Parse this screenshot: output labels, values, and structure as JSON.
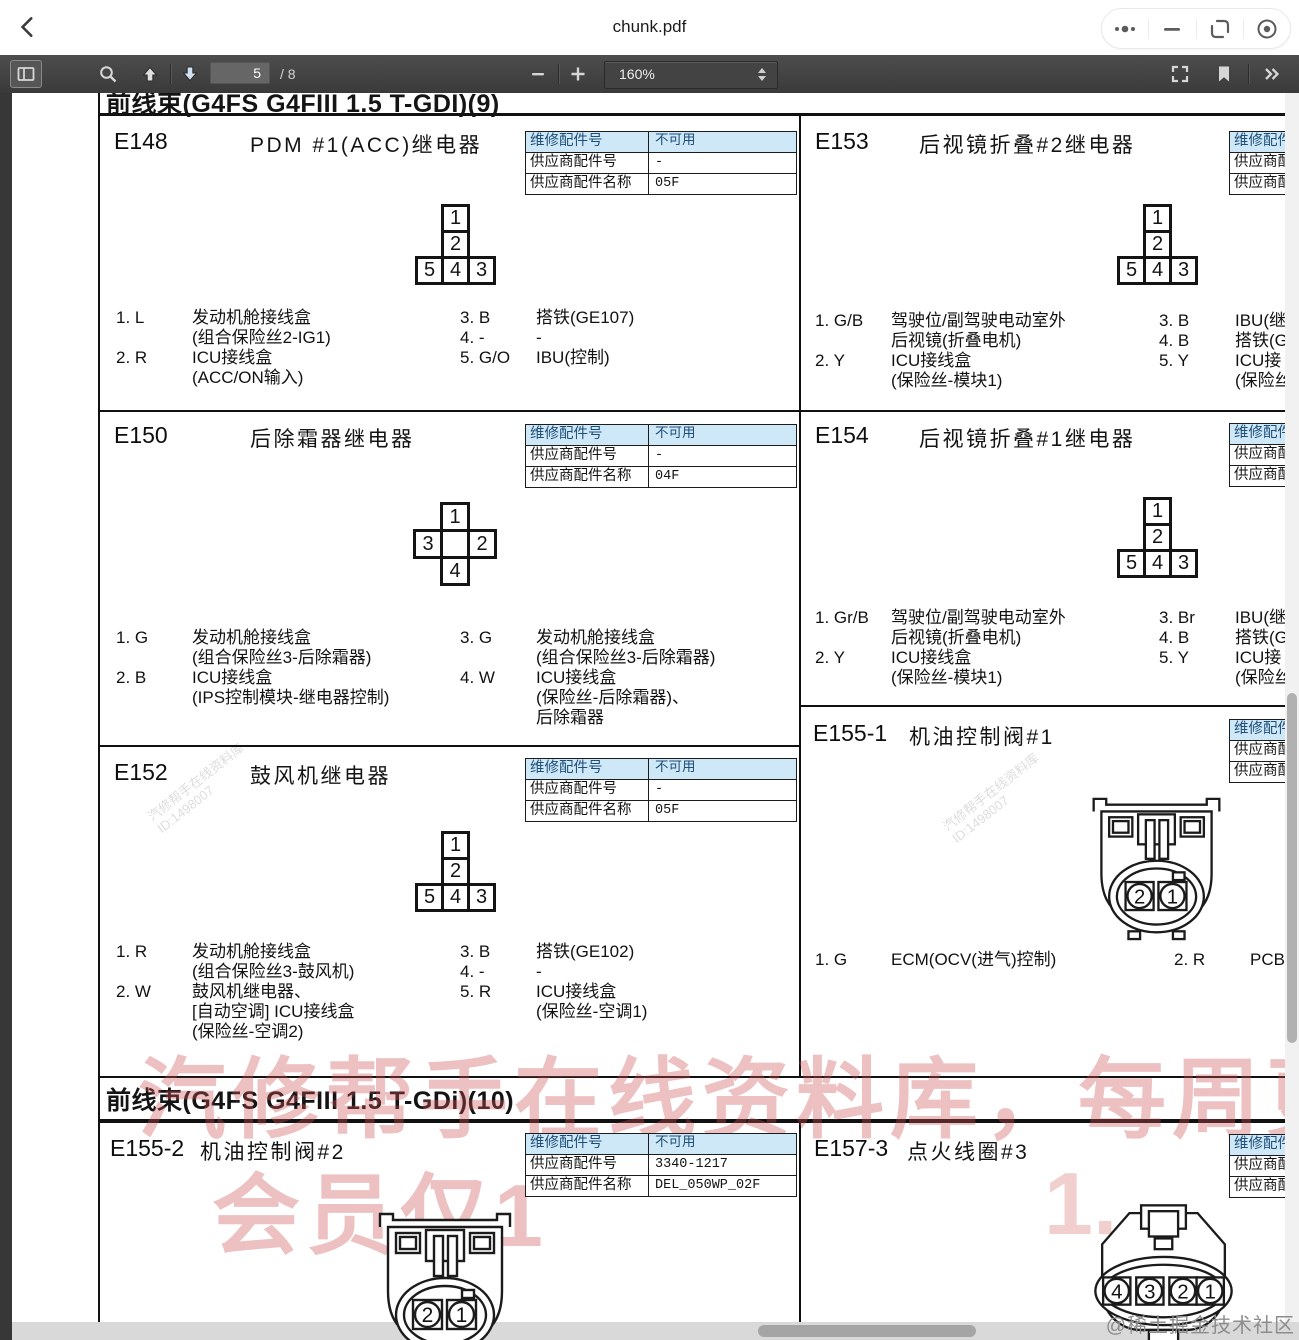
{
  "window": {
    "title": "chunk.pdf"
  },
  "toolbar": {
    "page": "5",
    "page_total": "/ 8",
    "zoom": "160%"
  },
  "headers": {
    "section9": "前线束(G4FS  G4FIII 1.5 T-GDI)(9)",
    "section10": "前线束(G4FS  G4FIII 1.5 T-GDi)(10)"
  },
  "table_labels": [
    "维修配件号",
    "供应商配件号",
    "供应商配件名称"
  ],
  "connectors": {
    "t5_top": [
      "1",
      "2"
    ],
    "t5_bottom": [
      "5",
      "4",
      "3"
    ],
    "plus4": {
      "top": "1",
      "left": "3",
      "right": "2",
      "bottom": "4"
    },
    "round2": [
      "2",
      "1"
    ],
    "oval4": [
      "4",
      "3",
      "2",
      "1"
    ]
  },
  "cells": {
    "e148": {
      "id": "E148",
      "name": "PDM #1(ACC)继电器",
      "values": [
        "不可用",
        "-",
        "05F"
      ],
      "pins": [
        {
          "n": "1. L",
          "d": "发动机舱接线盒\n(组合保险丝2-IG1)"
        },
        {
          "n": "2. R",
          "d": "ICU接线盒\n(ACC/ON输入)"
        },
        {
          "n": "3. B",
          "d": "搭铁(GE107)"
        },
        {
          "n": "4. -",
          "d": "-"
        },
        {
          "n": "5. G/O",
          "d": "IBU(控制)"
        }
      ]
    },
    "e150": {
      "id": "E150",
      "name": "后除霜器继电器",
      "values": [
        "不可用",
        "-",
        "04F"
      ],
      "pins": [
        {
          "n": "1. G",
          "d": "发动机舱接线盒\n(组合保险丝3-后除霜器)"
        },
        {
          "n": "2. B",
          "d": "ICU接线盒\n(IPS控制模块-继电器控制)"
        },
        {
          "n": "3. G",
          "d": "发动机舱接线盒\n(组合保险丝3-后除霜器)"
        },
        {
          "n": "4. W",
          "d": "ICU接线盒\n(保险丝-后除霜器)、\n后除霜器"
        }
      ]
    },
    "e152": {
      "id": "E152",
      "name": "鼓风机继电器",
      "values": [
        "不可用",
        "-",
        "05F"
      ],
      "pins": [
        {
          "n": "1. R",
          "d": "发动机舱接线盒\n(组合保险丝3-鼓风机)"
        },
        {
          "n": "2. W",
          "d": "鼓风机继电器、\n[自动空调] ICU接线盒\n(保险丝-空调2)"
        },
        {
          "n": "3. B",
          "d": "搭铁(GE102)"
        },
        {
          "n": "4. -",
          "d": "-"
        },
        {
          "n": "5. R",
          "d": "ICU接线盒\n(保险丝-空调1)"
        }
      ]
    },
    "e153": {
      "id": "E153",
      "name": "后视镜折叠#2继电器",
      "pins": [
        {
          "n": "1. G/B",
          "d": "驾驶位/副驾驶电动室外\n后视镜(折叠电机)"
        },
        {
          "n": "2. Y",
          "d": "ICU接线盒\n(保险丝-模块1)"
        },
        {
          "n": "3. B",
          "d": "IBU(继"
        },
        {
          "n": "4. B",
          "d": "搭铁(G"
        },
        {
          "n": "5. Y",
          "d": "ICU接\n(保险丝"
        }
      ]
    },
    "e154": {
      "id": "E154",
      "name": "后视镜折叠#1继电器",
      "pins": [
        {
          "n": "1. Gr/B",
          "d": "驾驶位/副驾驶电动室外\n后视镜(折叠电机)"
        },
        {
          "n": "2. Y",
          "d": "ICU接线盒\n(保险丝-模块1)"
        },
        {
          "n": "3. Br",
          "d": "IBU(继"
        },
        {
          "n": "4. B",
          "d": "搭铁(G"
        },
        {
          "n": "5. Y",
          "d": "ICU接\n(保险丝"
        }
      ]
    },
    "e155_1": {
      "id": "E155-1",
      "name": "机油控制阀#1",
      "pins": [
        {
          "n": "1. G",
          "d": "ECM(OCV(进气)控制)"
        },
        {
          "n": "2. R",
          "d": "PCB"
        }
      ]
    },
    "e155_2": {
      "id": "E155-2",
      "name": "机油控制阀#2",
      "values": [
        "不可用",
        "3340-1217",
        "DEL_050WP_02F"
      ]
    },
    "e157_3": {
      "id": "E157-3",
      "name": "点火线圈#3"
    }
  },
  "watermarks": {
    "line1": "汽修帮手在线资料库，每周更",
    "line2": "会员仅1",
    "line2_frag": "1.",
    "diag_text": "汽修帮手在线资料库",
    "diag_id": "ID:1498007",
    "corner": "@稀土掘金技术社区"
  }
}
